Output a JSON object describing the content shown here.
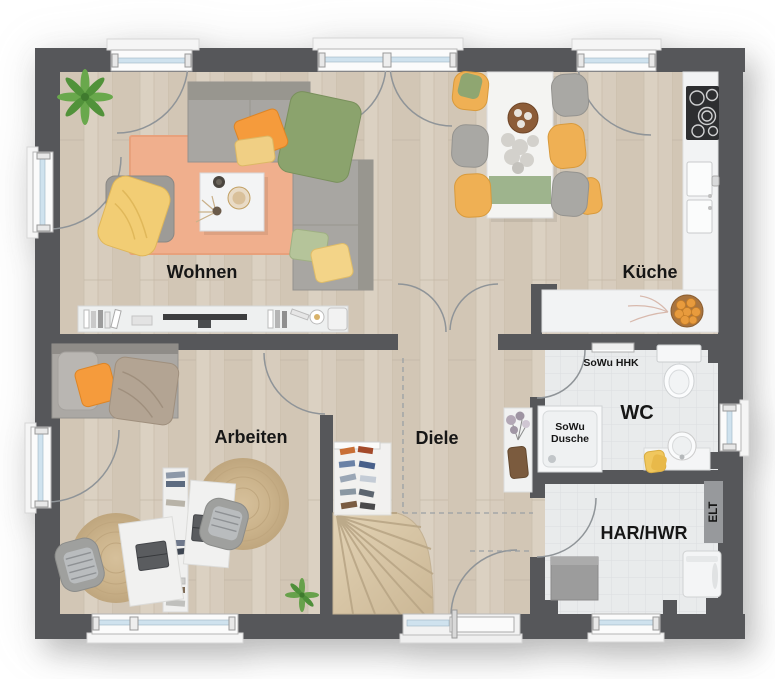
{
  "plan_title": "floor-plan-ground-floor",
  "rooms": {
    "wohnen": {
      "label": "Wohnen"
    },
    "kueche": {
      "label": "Küche"
    },
    "arbeiten": {
      "label": "Arbeiten"
    },
    "diele": {
      "label": "Diele"
    },
    "wc": {
      "label": "WC"
    },
    "har_hwr": {
      "label": "HAR/HWR"
    }
  },
  "annotations": {
    "hhk": "SoWu HHK",
    "shower_line1": "SoWu",
    "shower_line2": "Dusche",
    "elt": "ELT"
  },
  "colors": {
    "wall": "#56575a",
    "wood_floor": "#d7ccbd",
    "tile_floor": "#e9ebec",
    "living_rug": "#f0af8d",
    "accent_orange": "#f59b3c",
    "accent_yellow": "#f0cf84",
    "accent_green": "#8ba36d",
    "chair_yellow": "#efb054",
    "sofa_gray": "#a8a6a2",
    "window_glass": "#cfe2ee",
    "stair_wood": "#d9c7a9"
  }
}
